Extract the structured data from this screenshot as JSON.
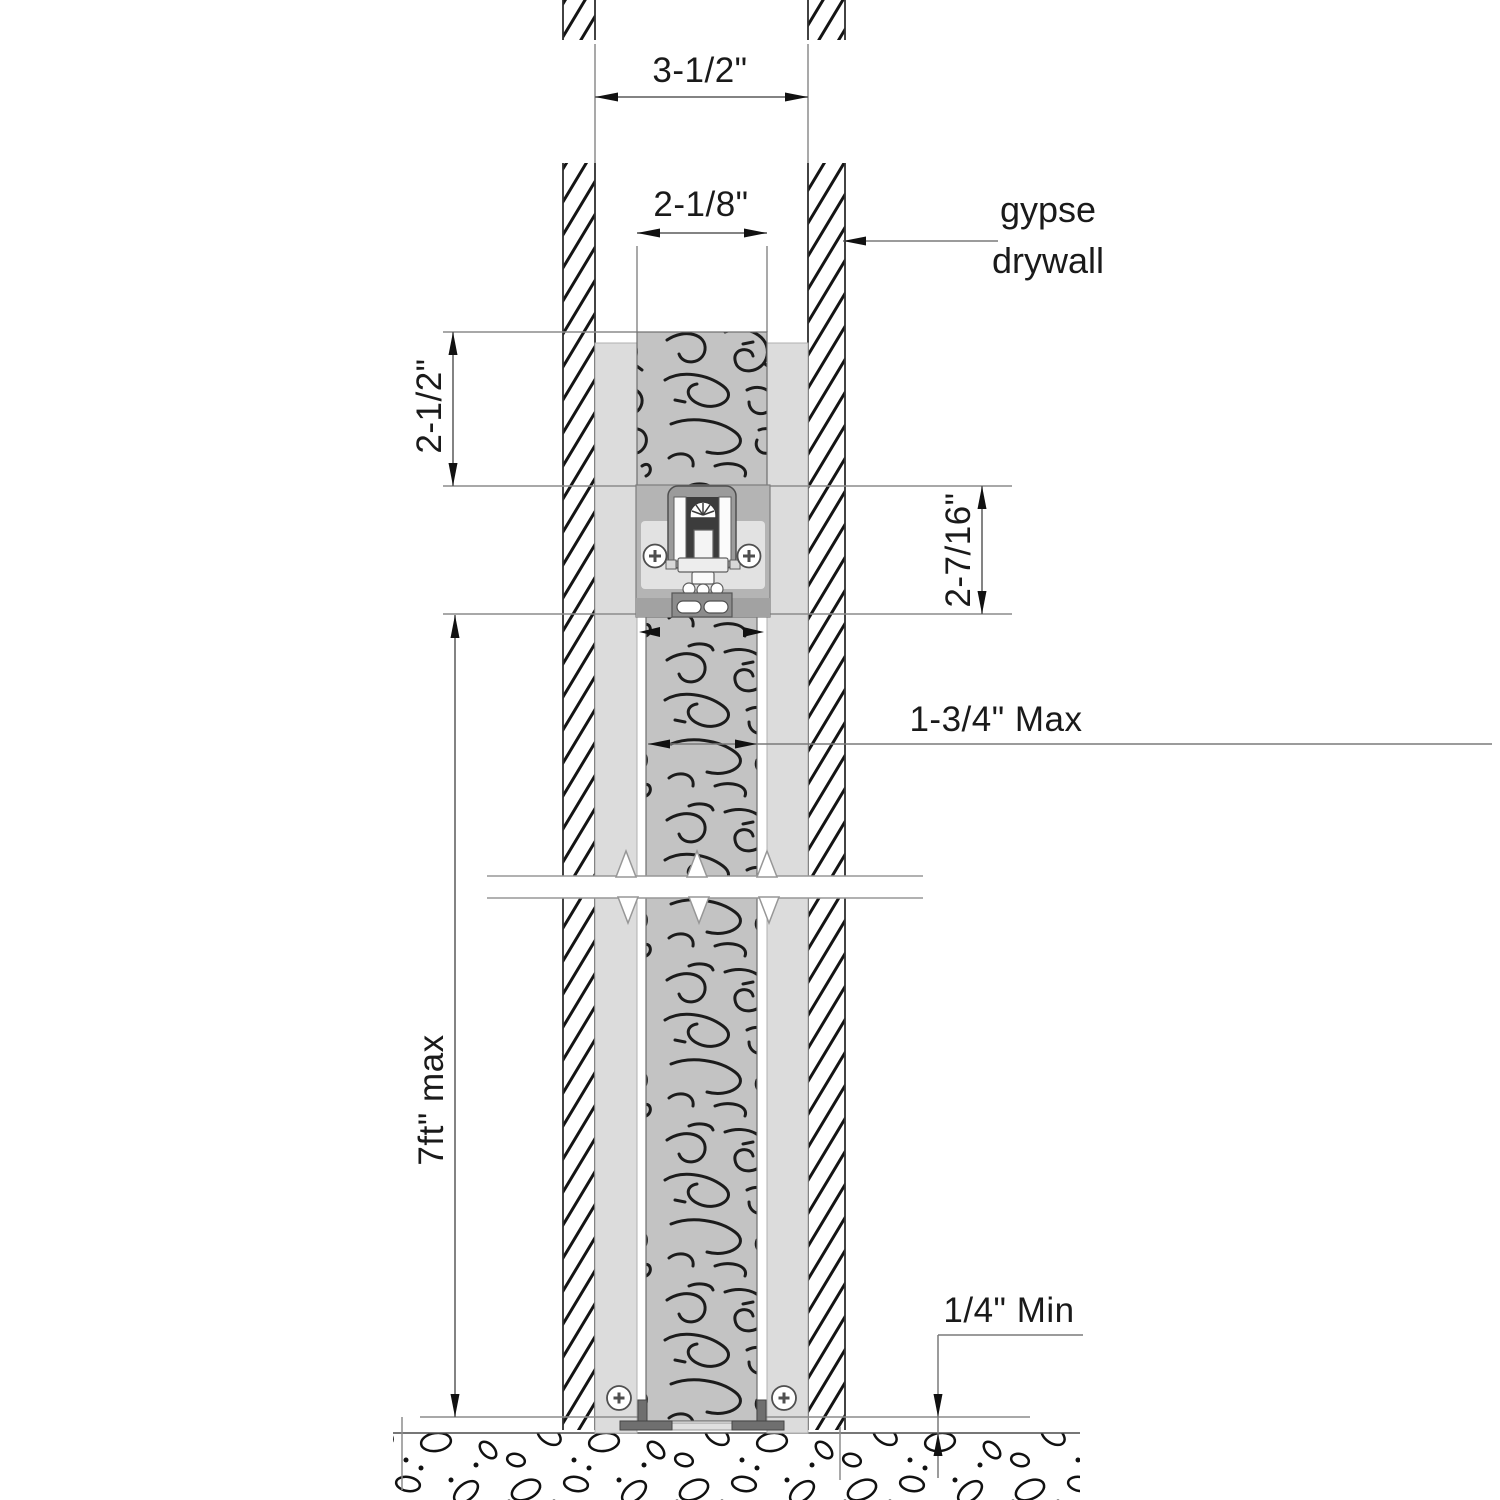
{
  "drawing": {
    "dimensions": {
      "wall_opening_width": "3-1/2\"",
      "track_header_width": "2-1/8\"",
      "header_height": "2-1/2\"",
      "track_space_height": "2-7/16\"",
      "door_thickness": "1-3/4\" Max",
      "door_height": "7ft\" max",
      "floor_clearance": "1/4\" Min"
    },
    "labels": {
      "wall_material_line1": "gypse",
      "wall_material_line2": "drywall"
    },
    "colors": {
      "ink": "#1a1a1a",
      "dimension_line": "#8c8c8c",
      "wall_hatch": "#141414",
      "lining_fill": "#dcdcdc",
      "wood_fill": "#c3c3c3",
      "grain_stroke": "#1c1c1c",
      "plate_fill": "#b4b4b4",
      "panel_fill": "#e2e2e2",
      "channel_fill": "#9b9b9b",
      "channel_slot": "#3c3c3c",
      "bracket_fill": "#8c8c8c",
      "floor_ink": "#111111"
    }
  }
}
